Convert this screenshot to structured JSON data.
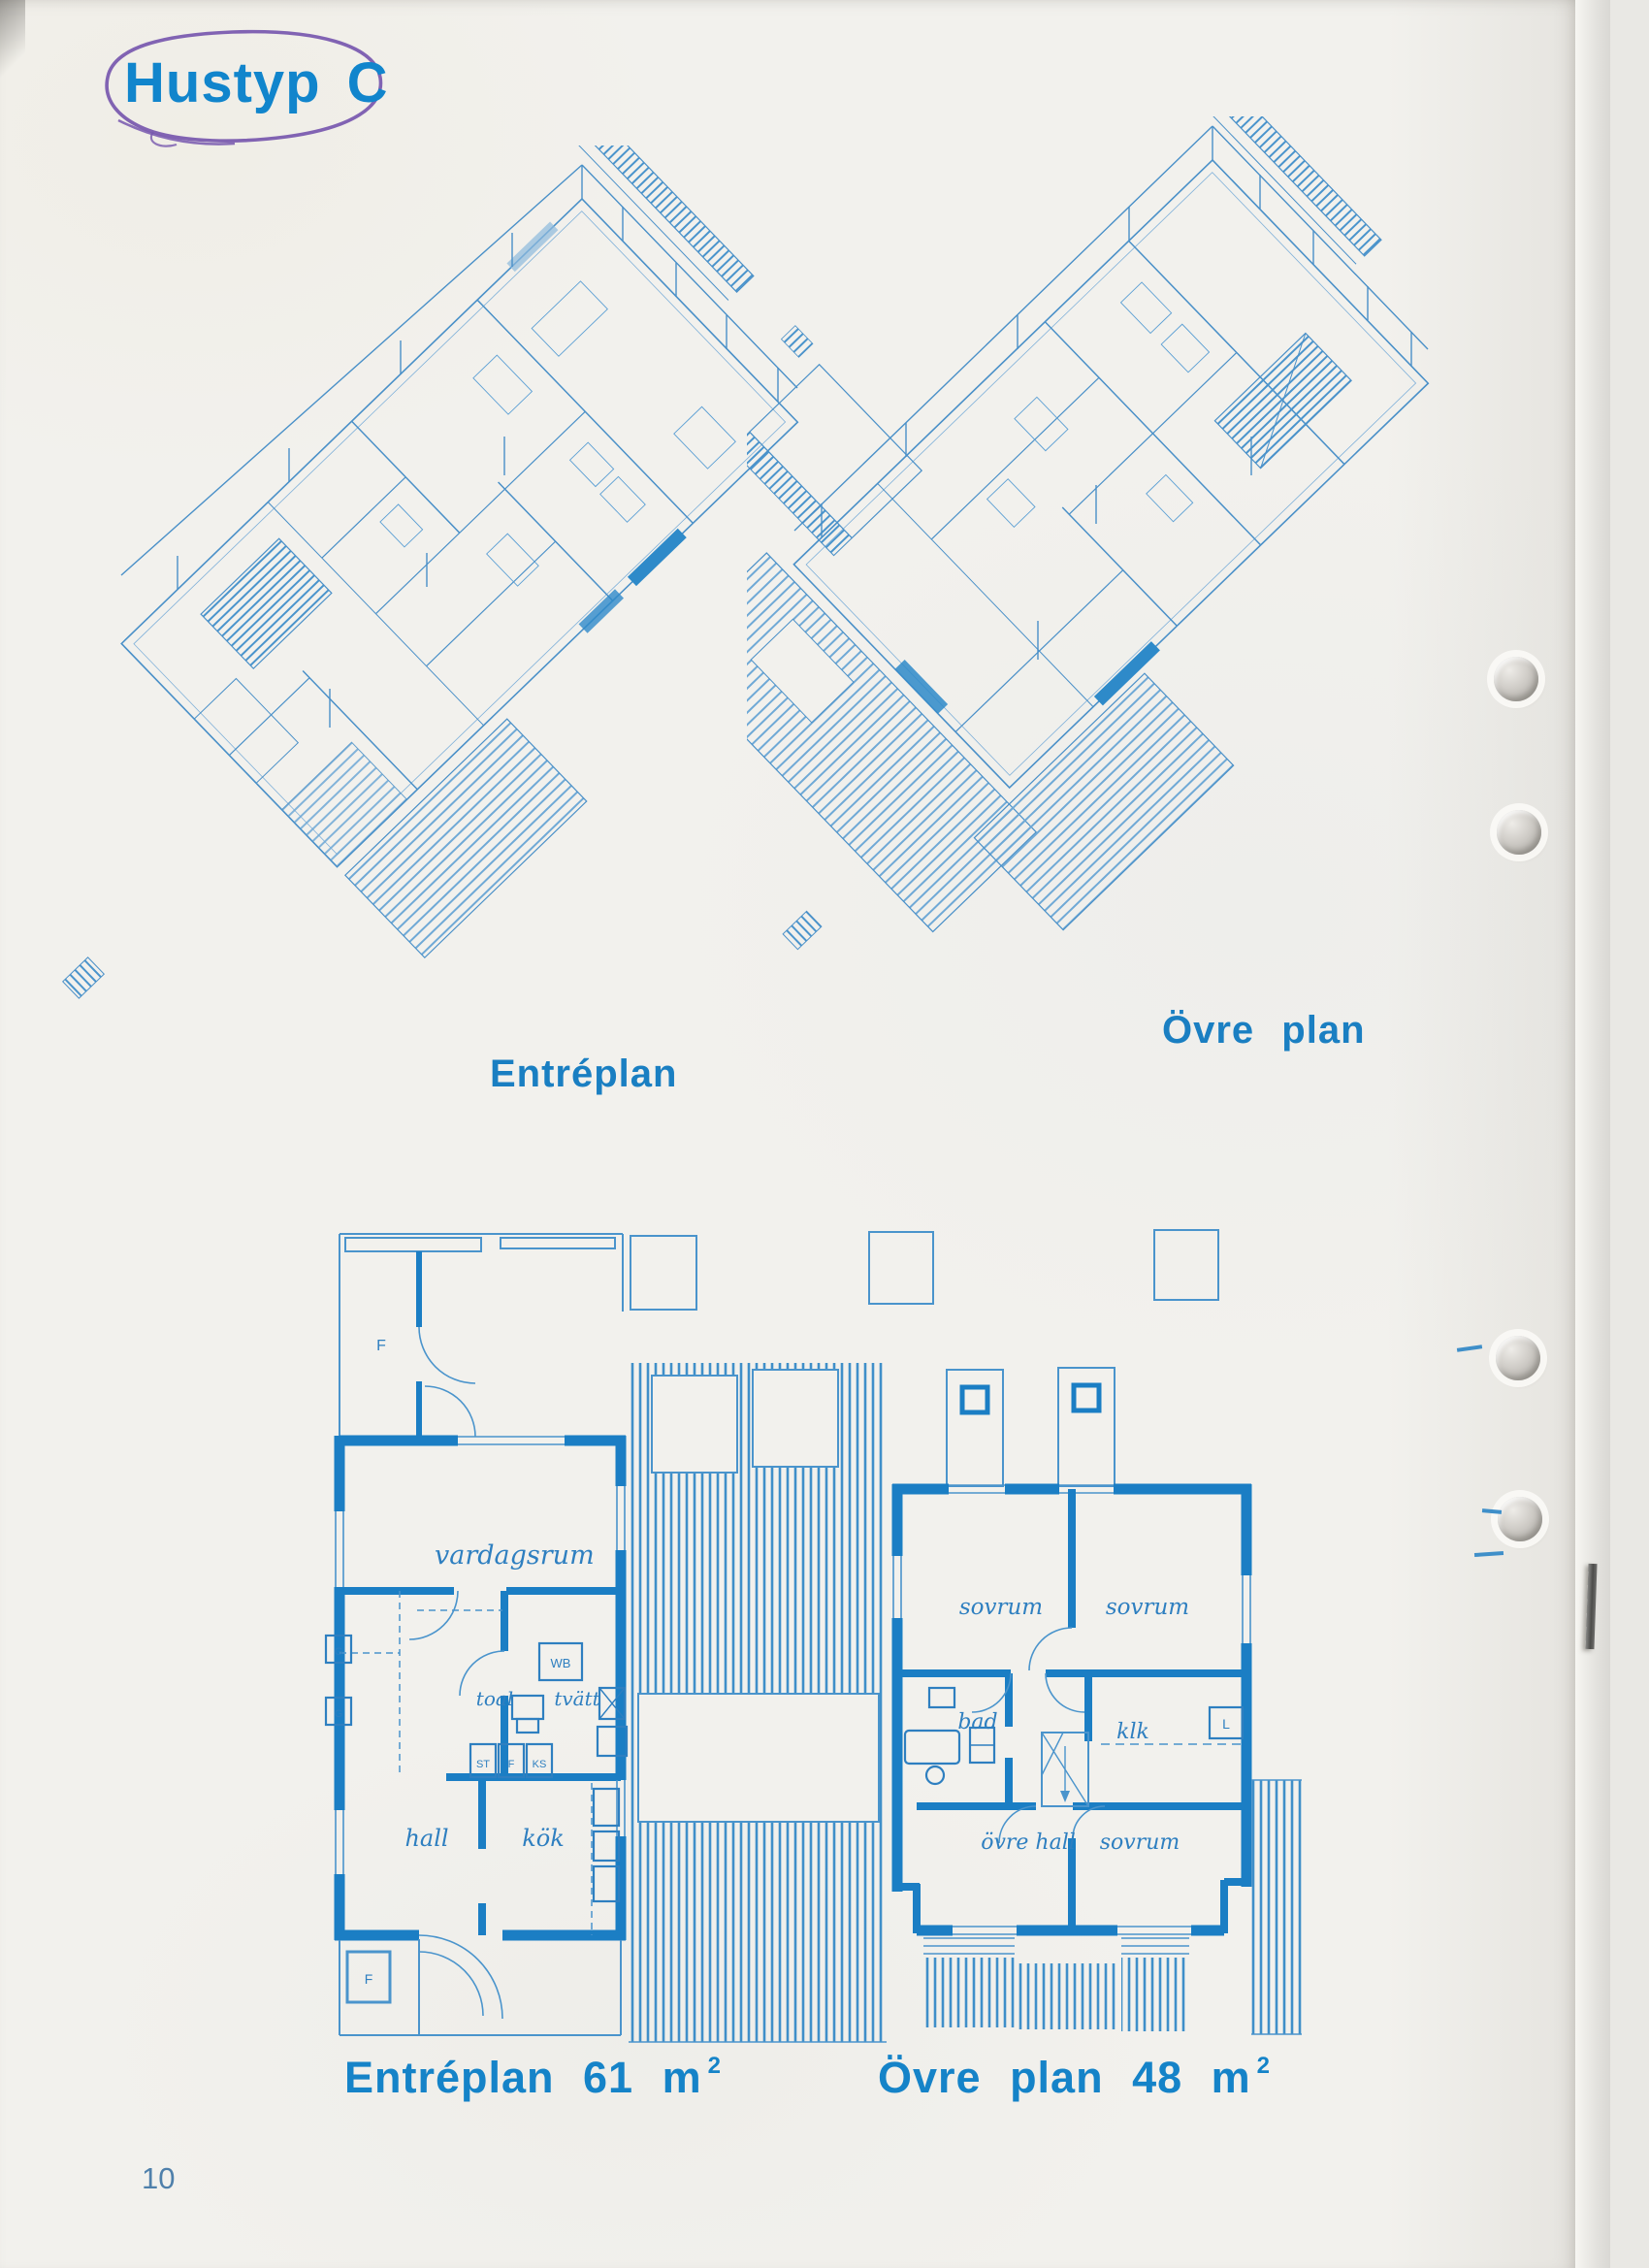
{
  "page": {
    "title": "Hustyp C",
    "page_number": "10"
  },
  "axon": {
    "entreplan_label": "Entréplan",
    "ovreplan_label": "Övre plan"
  },
  "plans": {
    "entreplan": {
      "caption": "Entréplan 61 m",
      "caption_sup": "2",
      "rooms": {
        "vardagsrum": "vardagsrum",
        "toal": "toal",
        "tvatt": "tvätt",
        "wb": "WB",
        "st": "ST",
        "f_mid": "F",
        "ks": "KS",
        "hall": "hall",
        "kok": "kök",
        "f_top": "F",
        "f_bottom": "F",
        "g_upper": "G",
        "g_lower": "G"
      }
    },
    "ovreplan": {
      "caption": "Övre plan 48 m",
      "caption_sup": "2",
      "rooms": {
        "sovrum_left": "sovrum",
        "sovrum_right": "sovrum",
        "bad": "bad",
        "klk": "klk",
        "l": "L",
        "ovre_hall": "övre hall",
        "sovrum_bottom": "sovrum"
      }
    }
  },
  "colors": {
    "ink_heavy_blue": "#1b7ec4",
    "ink_line_blue": "#4a94cc",
    "heading_blue": "#1583c8",
    "pen_purple": "#7757ae",
    "paper": "#f2f1ed"
  }
}
